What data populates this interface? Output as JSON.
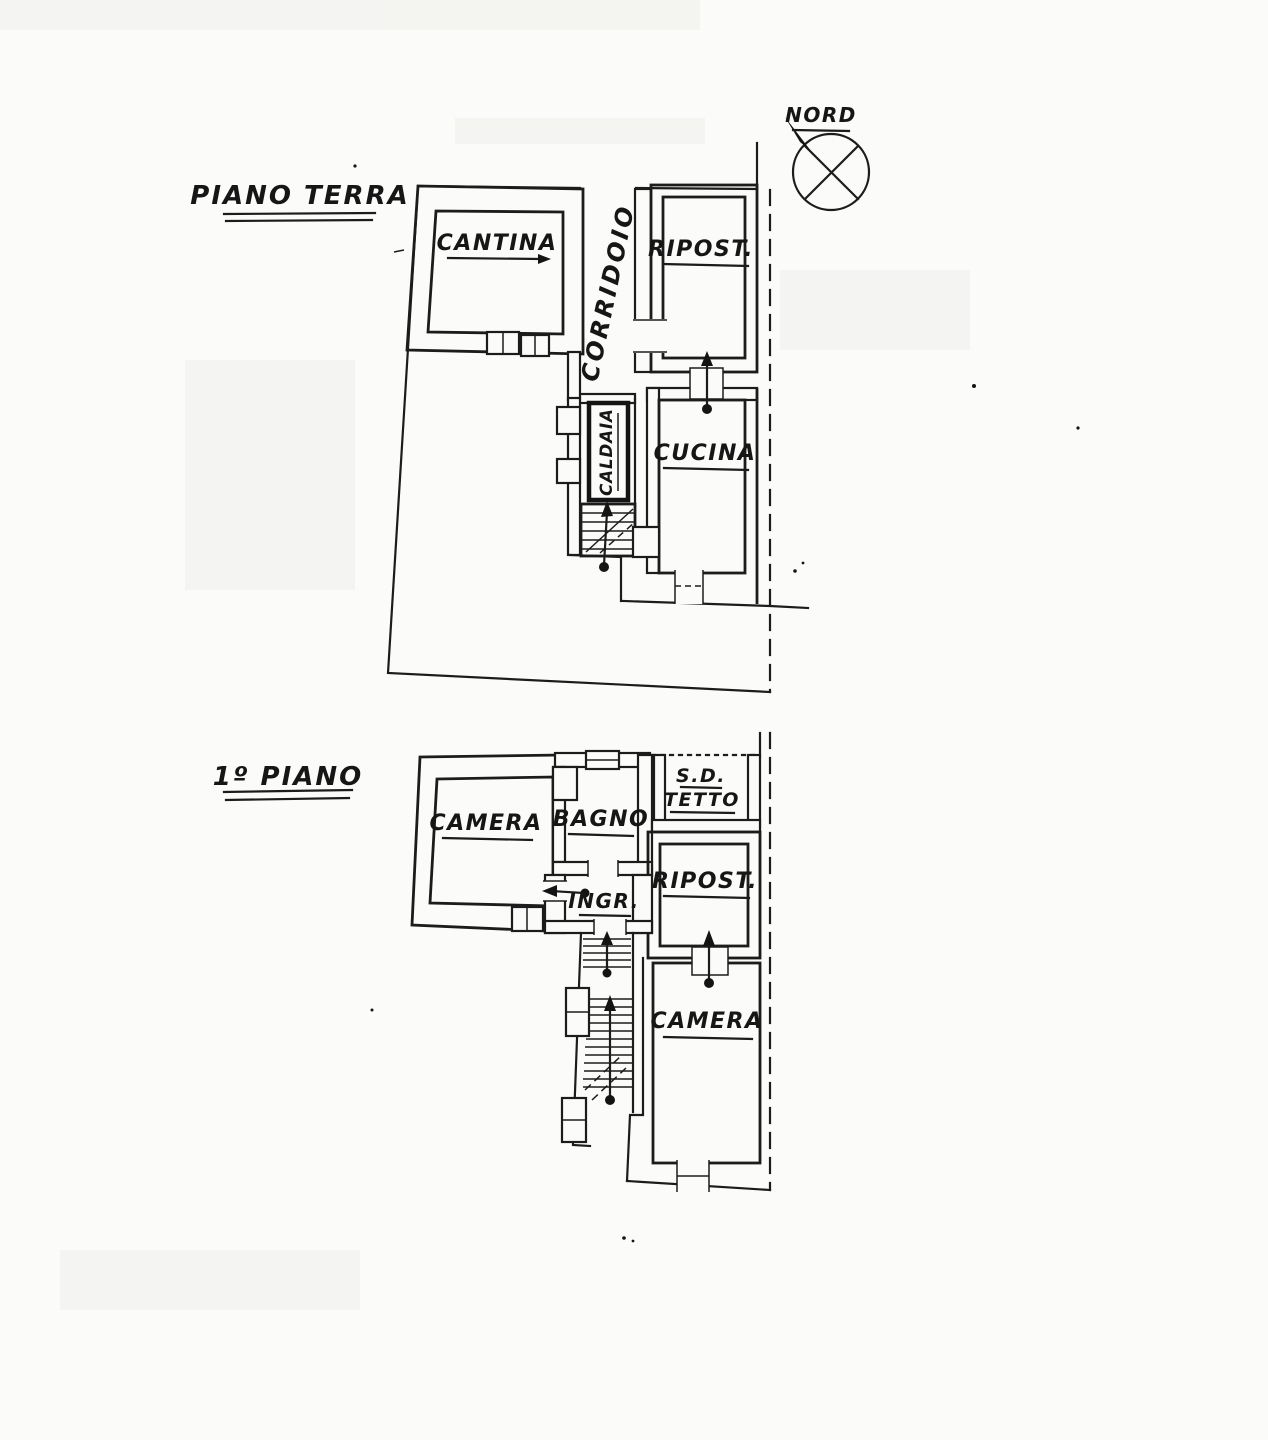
{
  "compass": {
    "label": "NORD"
  },
  "ground_floor": {
    "title": "PIANO TERRA",
    "rooms": {
      "cantina": "CANTINA",
      "corridoio": "CORRIDOIO",
      "ripostiglio": "RIPOST.",
      "cucina": "CUCINA",
      "caldaia": "CALDAIA"
    }
  },
  "first_floor": {
    "title": "1º PIANO",
    "rooms": {
      "camera_nord": "CAMERA",
      "bagno": "BAGNO",
      "sottotetto_1": "S.D.",
      "sottotetto_2": "TETTO",
      "ingresso": "INGR.",
      "ripostiglio": "RIPOST.",
      "camera_sud": "CAMERA"
    }
  }
}
